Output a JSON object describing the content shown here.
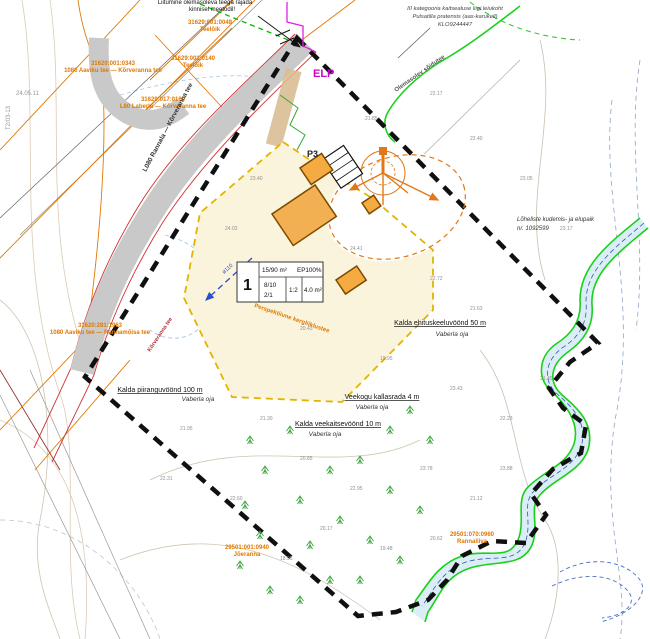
{
  "colors": {
    "road_gray": "#c9c9c9",
    "cadastral_orange": "#e07800",
    "boundary_black": "#101010",
    "parcel_yellow": "#fbf4dc",
    "gold_dash": "#e2b400",
    "building_orange": "#f5ab42",
    "stream_green": "#19d119",
    "water_blue": "#d9edf6",
    "magenta": "#cc00cc",
    "red_edge": "#cc3333",
    "pipe_blue": "#2b50c8"
  },
  "notes": {
    "top1": "Liitumine olemasoleva teega rajada",
    "top2": "kinnisel meetodil!",
    "prot1": "III kategooria kaitsealuse liigi leiukoht",
    "prot2": "Pulsatilla pratensis (aas-karukell)",
    "prot3": "KLO9244447",
    "fish1": "Lõheliste kudemis- ja elupaik",
    "fish2": "nr. 1092599"
  },
  "markers": {
    "elp": "ELP",
    "p3": "P3",
    "pipe": "ø110",
    "frame_ref": "T2/03-13",
    "grid_date": "24.05.11"
  },
  "table": {
    "pos": "1",
    "area": "15/90 m²",
    "ep": "EP100%",
    "r1": "8/10",
    "r2": "2/1",
    "mid": "1:2",
    "right": "4.0 m²"
  },
  "zones": [
    {
      "t": "Kalda ehituskeeluvöönd 50 m",
      "s": "Vaberla oja",
      "x": 440,
      "y": 325,
      "sx": 452,
      "sy": 336
    },
    {
      "t": "Veekogu kallasrada 4 m",
      "s": "Vaberla oja",
      "x": 382,
      "y": 399,
      "sx": 372,
      "sy": 409
    },
    {
      "t": "Kalda veekaitsevöönd 10 m",
      "s": "Vaberla oja",
      "x": 338,
      "y": 426,
      "sx": 325,
      "sy": 436
    },
    {
      "t": "Kalda piiranguvöönd 100 m",
      "s": "Vaberla oja",
      "x": 160,
      "y": 392,
      "sx": 198,
      "sy": 401
    }
  ],
  "cadastral": [
    {
      "a": "31620:001:0343",
      "b": "1080 Aaviku tee — Kõrveranna tee",
      "x": 113,
      "y": 65
    },
    {
      "a": "31629:017:0160",
      "b": "L80 Laberla — Kõrveranna tee",
      "x": 163,
      "y": 101
    },
    {
      "a": "31629:001:0049",
      "b": "Teelõik",
      "x": 210,
      "y": 24
    },
    {
      "a": "31629:001:0140",
      "b": "Teelõik",
      "x": 193,
      "y": 60
    },
    {
      "a": "31620:281:1963",
      "b": "1080 Aaviku tee — Rannamõisa tee",
      "x": 100,
      "y": 327
    },
    {
      "a": "29501:070:0960",
      "b": "Rannaliiva",
      "x": 472,
      "y": 536
    },
    {
      "a": "29501:001:0940",
      "b": "Jõeranna",
      "x": 247,
      "y": 549
    }
  ],
  "roads": [
    {
      "label": "L080 Rannala — Kõrveranna tee",
      "x": 146,
      "y": 172,
      "rot": -62,
      "color": "#333333",
      "size": 6.5
    },
    {
      "label": "Kõrveranna tee",
      "x": 150,
      "y": 352,
      "rot": -56,
      "color": "#b03030",
      "size": 5.5
    },
    {
      "label": "Olemasolev sõidutee",
      "x": 396,
      "y": 92,
      "rot": -35,
      "color": "#555555",
      "size": 6
    },
    {
      "label": "Perspektiivne kergliiklustee",
      "x": 254,
      "y": 307,
      "rot": 19,
      "color": "#e07800",
      "size": 6
    }
  ],
  "elevations": [
    {
      "v": "21.85",
      "x": 365,
      "y": 120
    },
    {
      "v": "22.17",
      "x": 430,
      "y": 95
    },
    {
      "v": "22.40",
      "x": 470,
      "y": 140
    },
    {
      "v": "23.05",
      "x": 520,
      "y": 180
    },
    {
      "v": "23.17",
      "x": 560,
      "y": 230
    },
    {
      "v": "23.40",
      "x": 250,
      "y": 180
    },
    {
      "v": "24.02",
      "x": 225,
      "y": 230
    },
    {
      "v": "24.41",
      "x": 350,
      "y": 250
    },
    {
      "v": "22.72",
      "x": 430,
      "y": 280
    },
    {
      "v": "21.63",
      "x": 470,
      "y": 310
    },
    {
      "v": "20.43",
      "x": 300,
      "y": 330
    },
    {
      "v": "19.95",
      "x": 380,
      "y": 360
    },
    {
      "v": "23.43",
      "x": 450,
      "y": 390
    },
    {
      "v": "22.23",
      "x": 500,
      "y": 420
    },
    {
      "v": "21.30",
      "x": 260,
      "y": 420
    },
    {
      "v": "20.85",
      "x": 300,
      "y": 460
    },
    {
      "v": "22.95",
      "x": 350,
      "y": 490
    },
    {
      "v": "23.78",
      "x": 420,
      "y": 470
    },
    {
      "v": "21.12",
      "x": 470,
      "y": 500
    },
    {
      "v": "20.17",
      "x": 320,
      "y": 530
    },
    {
      "v": "19.48",
      "x": 380,
      "y": 550
    },
    {
      "v": "18.95",
      "x": 280,
      "y": 560
    },
    {
      "v": "22.60",
      "x": 230,
      "y": 500
    },
    {
      "v": "23.88",
      "x": 500,
      "y": 470
    },
    {
      "v": "21.45",
      "x": 540,
      "y": 380
    },
    {
      "v": "20.62",
      "x": 430,
      "y": 540
    },
    {
      "v": "21.95",
      "x": 180,
      "y": 430
    },
    {
      "v": "22.31",
      "x": 160,
      "y": 480
    }
  ],
  "trees": [
    [
      250,
      440
    ],
    [
      265,
      470
    ],
    [
      245,
      505
    ],
    [
      260,
      535
    ],
    [
      240,
      565
    ],
    [
      270,
      590
    ],
    [
      300,
      600
    ],
    [
      330,
      580
    ],
    [
      310,
      545
    ],
    [
      340,
      520
    ],
    [
      370,
      540
    ],
    [
      300,
      500
    ],
    [
      330,
      470
    ],
    [
      360,
      460
    ],
    [
      390,
      490
    ],
    [
      420,
      510
    ],
    [
      360,
      580
    ],
    [
      400,
      560
    ],
    [
      430,
      440
    ],
    [
      390,
      430
    ],
    [
      290,
      430
    ],
    [
      410,
      410
    ]
  ]
}
